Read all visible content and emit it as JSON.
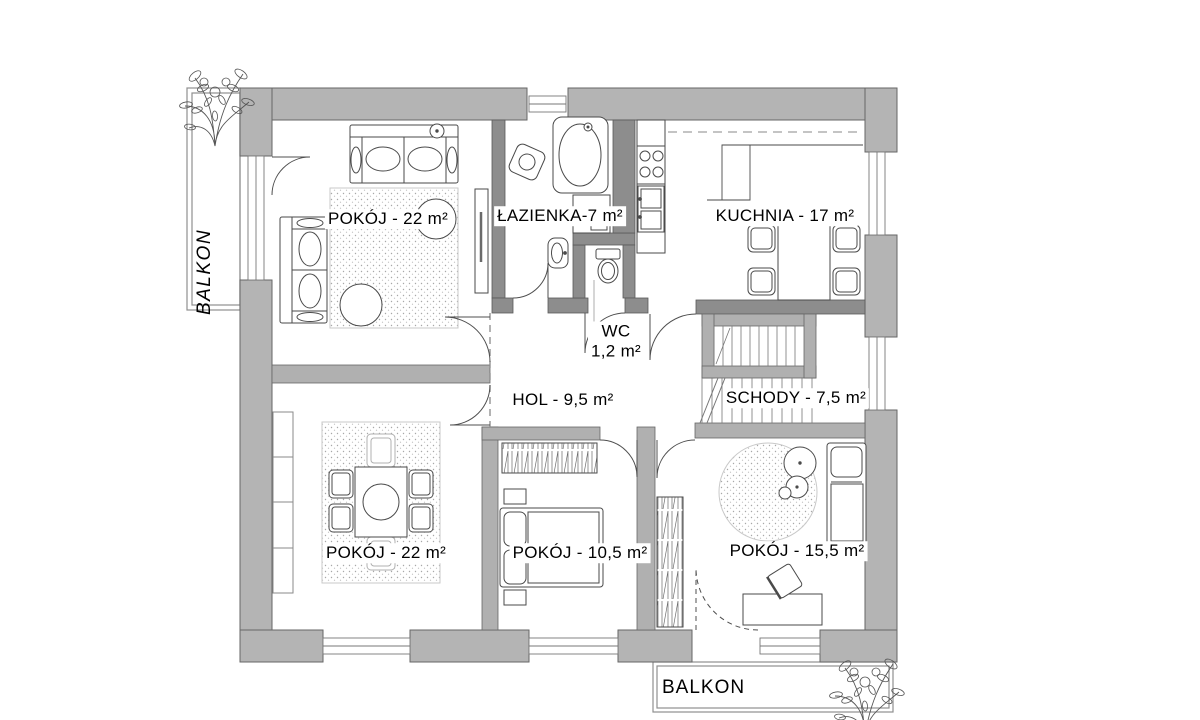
{
  "plan": {
    "title_hint": "apartment floor plan",
    "rooms": [
      {
        "name": "living-room",
        "label": "POKÓJ - 22 m²"
      },
      {
        "name": "bathroom",
        "label": "ŁAZIENKA-7 m²"
      },
      {
        "name": "kitchen",
        "label": "KUCHNIA - 17 m²"
      },
      {
        "name": "wc",
        "label": "WC",
        "area": "1,2 m²"
      },
      {
        "name": "hall",
        "label": "HOL - 9,5 m²"
      },
      {
        "name": "stairs",
        "label": "SCHODY - 7,5 m²"
      },
      {
        "name": "dining-room",
        "label": "POKÓJ - 22 m²"
      },
      {
        "name": "bedroom-small",
        "label": "POKÓJ - 10,5 m²"
      },
      {
        "name": "bedroom-right",
        "label": "POKÓJ - 15,5 m²"
      }
    ],
    "balcony_left": "BALKON",
    "balcony_bottom": "BALKON",
    "colors": {
      "exterior_wall": "#b4b4b4",
      "interior_wall": "#8d8d8d",
      "light_wall": "#b0b0b0",
      "furniture_line": "#4a4a4a",
      "text": "#000000"
    }
  }
}
